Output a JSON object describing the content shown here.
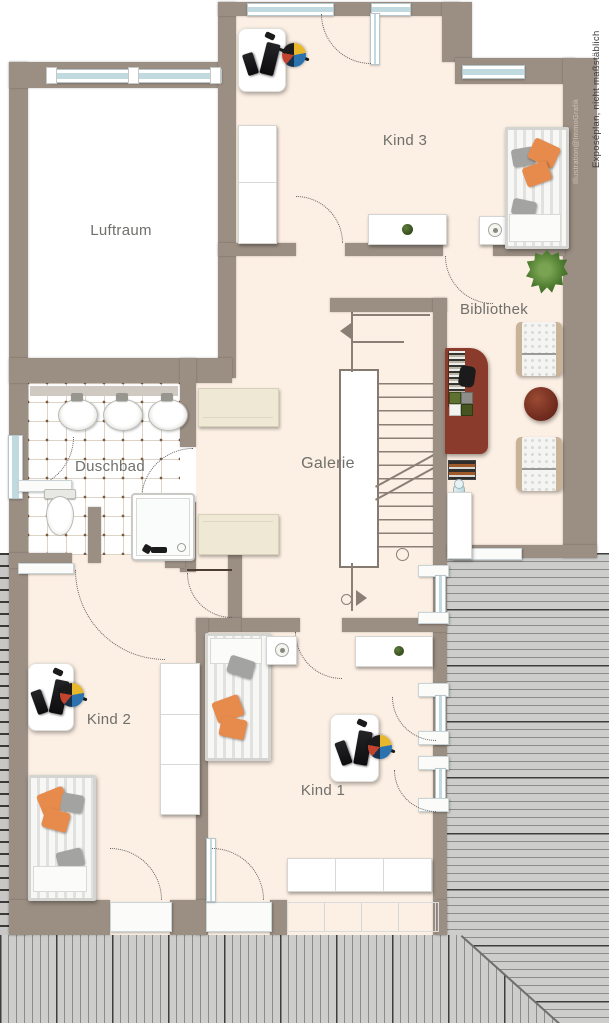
{
  "title": "Obergeschoss Grundriss",
  "watermarks": {
    "primary": "Exposéplan, nicht maßstäblich",
    "secondary": "Illustration@ImmoGrafik"
  },
  "colors": {
    "wall": "#9b8e83",
    "floor": "#fcefe3",
    "void_floor": "#ffffff",
    "roof": "#cdcdcb",
    "window_glass": "#c0dae0",
    "pillow_orange": "#e78b4d",
    "pillow_gray": "#a3a3a1",
    "wood_furniture": "#8a3b2b",
    "label_text": "#6f6f6b"
  },
  "rooms": {
    "luftraum": {
      "label": "Luftraum",
      "furniture": []
    },
    "kind3": {
      "label": "Kind 3",
      "furniture": [
        "desk",
        "office-chair",
        "wardrobe",
        "sideboard-with-plant",
        "nightstand-with-lamp",
        "single-bed"
      ]
    },
    "bibliothek": {
      "label": "Bibliothek",
      "furniture": [
        "bookshelf-desk",
        "desk-chair",
        "armchair",
        "armchair",
        "round-table",
        "plant",
        "books",
        "floor-lamp",
        "cupboard"
      ]
    },
    "galerie": {
      "label": "Galerie",
      "furniture": [
        "dresser",
        "dresser",
        "staircase"
      ]
    },
    "duschbad": {
      "label": "Duschbad",
      "furniture": [
        "sink",
        "sink",
        "sink",
        "toilet",
        "shower",
        "bench"
      ]
    },
    "kind2": {
      "label": "Kind 2",
      "furniture": [
        "desk",
        "office-chair",
        "single-bed",
        "wardrobe"
      ]
    },
    "kind1": {
      "label": "Kind 1",
      "furniture": [
        "single-bed",
        "nightstand-with-lamp",
        "sideboard-with-plant",
        "desk",
        "office-chair",
        "sideboard"
      ]
    }
  }
}
